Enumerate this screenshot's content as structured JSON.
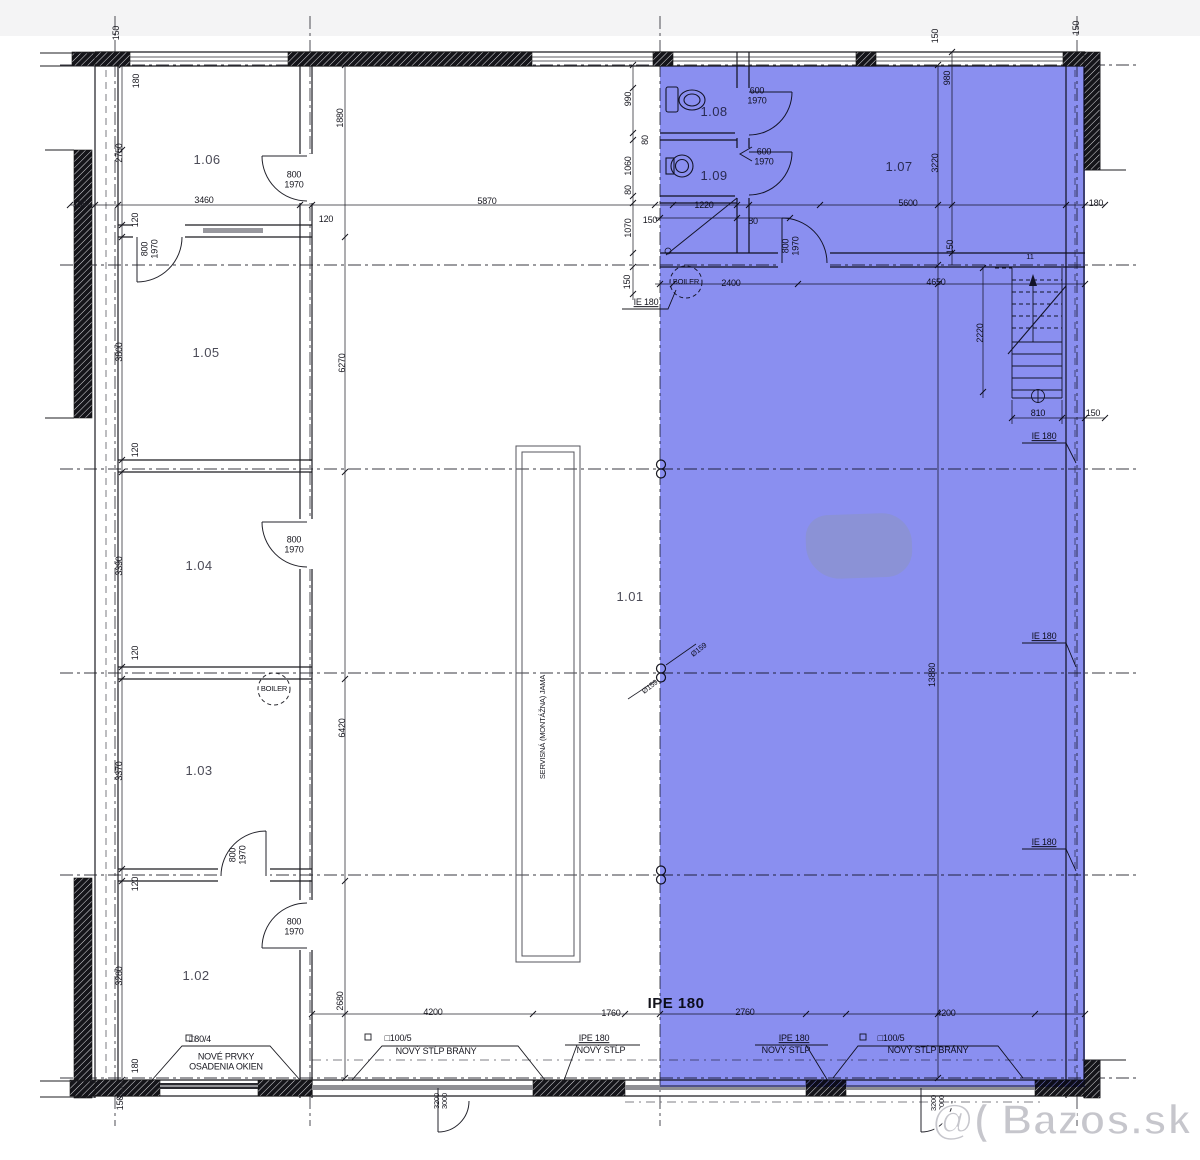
{
  "page": {
    "watermark": "@( Bazos.sk"
  },
  "drawing": {
    "type": "architectural floor plan",
    "highlight_color": "#8a8ff0",
    "line_color": "#1c1c22",
    "rooms": [
      "1.01",
      "1.02",
      "1.03",
      "1.04",
      "1.05",
      "1.06",
      "1.07",
      "1.08",
      "1.09"
    ],
    "annotations": [
      {
        "t": "150",
        "x": 117,
        "y": 33,
        "r": -90
      },
      {
        "t": "180",
        "x": 137,
        "y": 81,
        "r": -90
      },
      {
        "t": "2750",
        "x": 120,
        "y": 153,
        "r": -90
      },
      {
        "t": "1.06",
        "x": 207,
        "y": 160,
        "cls": "room",
        "n": "room-label-1-06"
      },
      {
        "t": "800\n1970",
        "x": 294,
        "y": 180,
        "n": "door-size-label"
      },
      {
        "t": "1880",
        "x": 341,
        "y": 118,
        "r": -90
      },
      {
        "t": "3460",
        "x": 204,
        "y": 201
      },
      {
        "t": "180",
        "x": 80,
        "y": 205
      },
      {
        "t": "120",
        "x": 136,
        "y": 220,
        "r": -90
      },
      {
        "t": "120",
        "x": 326,
        "y": 220
      },
      {
        "t": "5870",
        "x": 487,
        "y": 202
      },
      {
        "t": "800\n1970",
        "x": 150,
        "y": 249,
        "r": -90,
        "n": "door-size-label"
      },
      {
        "t": "3800",
        "x": 120,
        "y": 352,
        "r": -90
      },
      {
        "t": "1.05",
        "x": 206,
        "y": 353,
        "cls": "room",
        "n": "room-label-1-05"
      },
      {
        "t": "6270",
        "x": 343,
        "y": 363,
        "r": -90
      },
      {
        "t": "120",
        "x": 136,
        "y": 450,
        "r": -90
      },
      {
        "t": "3390",
        "x": 120,
        "y": 566,
        "r": -90
      },
      {
        "t": "1.04",
        "x": 199,
        "y": 566,
        "cls": "room",
        "n": "room-label-1-04"
      },
      {
        "t": "800\n1970",
        "x": 294,
        "y": 545,
        "n": "door-size-label"
      },
      {
        "t": "120",
        "x": 136,
        "y": 653,
        "r": -90
      },
      {
        "t": "BOILER",
        "x": 274,
        "y": 689,
        "cls": "tiny",
        "n": "boiler-label"
      },
      {
        "t": "3370",
        "x": 120,
        "y": 771,
        "r": -90
      },
      {
        "t": "1.03",
        "x": 199,
        "y": 771,
        "cls": "room",
        "n": "room-label-1-03"
      },
      {
        "t": "800\n1970",
        "x": 238,
        "y": 855,
        "r": -90,
        "n": "door-size-label"
      },
      {
        "t": "120",
        "x": 136,
        "y": 884,
        "r": -90
      },
      {
        "t": "800\n1970",
        "x": 294,
        "y": 927,
        "n": "door-size-label"
      },
      {
        "t": "3280",
        "x": 120,
        "y": 976,
        "r": -90
      },
      {
        "t": "1.02",
        "x": 196,
        "y": 976,
        "cls": "room",
        "n": "room-label-1-02"
      },
      {
        "t": "6420",
        "x": 343,
        "y": 728,
        "r": -90
      },
      {
        "t": "180",
        "x": 136,
        "y": 1066,
        "r": -90
      },
      {
        "t": "150",
        "x": 121,
        "y": 1103,
        "r": -90
      },
      {
        "t": "□80/4",
        "x": 200,
        "y": 1040,
        "n": "callout-size"
      },
      {
        "t": "NOVÉ PRVKY\nOSADENIA OKIEN",
        "x": 226,
        "y": 1062,
        "n": "callout-new-window-elements"
      },
      {
        "t": "1.01",
        "x": 630,
        "y": 597,
        "cls": "room",
        "n": "room-label-1-01"
      },
      {
        "t": "SERVISNÁ (MONTÁŽNA) JAMA",
        "x": 543,
        "y": 727,
        "r": -90,
        "cls": "tiny",
        "n": "service-pit-label"
      },
      {
        "t": "2680",
        "x": 341,
        "y": 1001,
        "r": -90
      },
      {
        "t": "4200",
        "x": 433,
        "y": 1013
      },
      {
        "t": "1760",
        "x": 611,
        "y": 1014
      },
      {
        "t": "IPE 180",
        "x": 676,
        "y": 1004,
        "cls": "big",
        "n": "beam-label"
      },
      {
        "t": "2760",
        "x": 745,
        "y": 1013
      },
      {
        "t": "4200",
        "x": 946,
        "y": 1014
      },
      {
        "t": "□100/5",
        "x": 398,
        "y": 1039,
        "n": "callout-size"
      },
      {
        "t": "NOVÝ STĹP BRÁNY",
        "x": 436,
        "y": 1052,
        "n": "callout-new-gate-post"
      },
      {
        "t": "IPE 180",
        "x": 594,
        "y": 1039,
        "cls": "u",
        "n": "beam-label"
      },
      {
        "t": "NOVÝ STĹP",
        "x": 601,
        "y": 1051,
        "n": "callout-new-post"
      },
      {
        "t": "3200\n3000",
        "x": 441,
        "y": 1101,
        "r": -90,
        "cls": "tiny",
        "n": "gate-size-label"
      },
      {
        "t": "IPE 180",
        "x": 794,
        "y": 1039,
        "cls": "u",
        "n": "beam-label"
      },
      {
        "t": "NOVÝ STĹP",
        "x": 786,
        "y": 1051,
        "n": "callout-new-post"
      },
      {
        "t": "□100/5",
        "x": 891,
        "y": 1039,
        "n": "callout-size"
      },
      {
        "t": "NOVÝ STĹP BRÁNY",
        "x": 928,
        "y": 1051,
        "n": "callout-new-gate-post"
      },
      {
        "t": "3200\n3000",
        "x": 938,
        "y": 1103,
        "r": -90,
        "cls": "tiny",
        "n": "gate-size-label"
      },
      {
        "t": "990",
        "x": 629,
        "y": 99,
        "r": -90
      },
      {
        "t": "80",
        "x": 646,
        "y": 140,
        "r": -90
      },
      {
        "t": "1060",
        "x": 629,
        "y": 166,
        "r": -90
      },
      {
        "t": "80",
        "x": 629,
        "y": 190,
        "r": -90
      },
      {
        "t": "1070",
        "x": 629,
        "y": 228,
        "r": -90
      },
      {
        "t": "150",
        "x": 650,
        "y": 221
      },
      {
        "t": "150",
        "x": 628,
        "y": 282,
        "r": -90
      },
      {
        "t": "IE 180",
        "x": 646,
        "y": 303,
        "cls": "u",
        "n": "beam-label"
      },
      {
        "t": "1.08",
        "x": 714,
        "y": 112,
        "cls": "room",
        "n": "room-label-1-08"
      },
      {
        "t": "600\n1970",
        "x": 757,
        "y": 96,
        "n": "door-size-label"
      },
      {
        "t": "1.09",
        "x": 714,
        "y": 176,
        "cls": "room",
        "n": "room-label-1-09"
      },
      {
        "t": "600\n1970",
        "x": 764,
        "y": 157,
        "n": "door-size-label"
      },
      {
        "t": "1.07",
        "x": 899,
        "y": 167,
        "cls": "room",
        "n": "room-label-1-07"
      },
      {
        "t": "1220",
        "x": 704,
        "y": 206
      },
      {
        "t": "80",
        "x": 753,
        "y": 222
      },
      {
        "t": "5600",
        "x": 908,
        "y": 204
      },
      {
        "t": "800\n1970",
        "x": 791,
        "y": 246,
        "r": -90,
        "n": "door-size-label"
      },
      {
        "t": "BOILER",
        "x": 686,
        "y": 282,
        "cls": "tiny",
        "n": "boiler-label"
      },
      {
        "t": "2400",
        "x": 731,
        "y": 284
      },
      {
        "t": "4650",
        "x": 936,
        "y": 283
      },
      {
        "t": "3220",
        "x": 936,
        "y": 163,
        "r": -90
      },
      {
        "t": "980",
        "x": 948,
        "y": 78,
        "r": -90
      },
      {
        "t": "150",
        "x": 951,
        "y": 247,
        "r": -90
      },
      {
        "t": "150",
        "x": 936,
        "y": 36,
        "r": -90
      },
      {
        "t": "150",
        "x": 1077,
        "y": 28,
        "r": -90
      },
      {
        "t": "180",
        "x": 1096,
        "y": 204
      },
      {
        "t": "11",
        "x": 1030,
        "y": 257,
        "cls": "tiny"
      },
      {
        "t": "2220",
        "x": 981,
        "y": 333,
        "r": -90
      },
      {
        "t": "810",
        "x": 1038,
        "y": 414
      },
      {
        "t": "150",
        "x": 1093,
        "y": 414
      },
      {
        "t": "IE 180",
        "x": 1044,
        "y": 437,
        "cls": "u",
        "n": "beam-label"
      },
      {
        "t": "IE 180",
        "x": 1044,
        "y": 637,
        "cls": "u",
        "n": "beam-label"
      },
      {
        "t": "IE 180",
        "x": 1044,
        "y": 843,
        "cls": "u",
        "n": "beam-label"
      },
      {
        "t": "13880",
        "x": 933,
        "y": 675,
        "r": -90
      },
      {
        "t": "Ø159",
        "x": 699,
        "y": 650,
        "r": -38,
        "cls": "tiny",
        "n": "pipe-diameter-label"
      },
      {
        "t": "Ø159",
        "x": 650,
        "y": 687,
        "r": -38,
        "cls": "tiny",
        "n": "pipe-diameter-label"
      }
    ]
  }
}
